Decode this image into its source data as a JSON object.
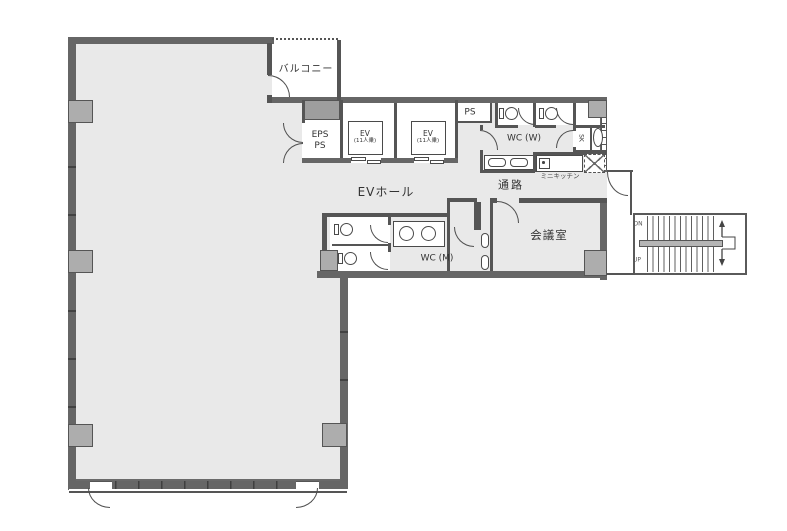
{
  "plan": {
    "title": "office-floor-plan",
    "labels": {
      "balcony": "バルコニー",
      "eps_line1": "EPS",
      "eps_line2": "PS",
      "ev_line1": "EV",
      "ev_line2": "(11人乗)",
      "ps": "PS",
      "wc_w": "WC (W)",
      "sk": "SK",
      "mini_kitchen": "ミニキッチン",
      "corridor": "通路",
      "ev_hall": "EVホール",
      "wc_m": "WC (M)",
      "meeting_room": "会議室",
      "stair_down": "DN",
      "stair_up": "UP"
    },
    "colors": {
      "floor": "#e9e9e9",
      "wall": "#666666",
      "thin_wall": "#555555",
      "pillar": "#adadad",
      "stair_rail": "#b5b5b5",
      "text": "#333333",
      "background": "#ffffff"
    }
  }
}
